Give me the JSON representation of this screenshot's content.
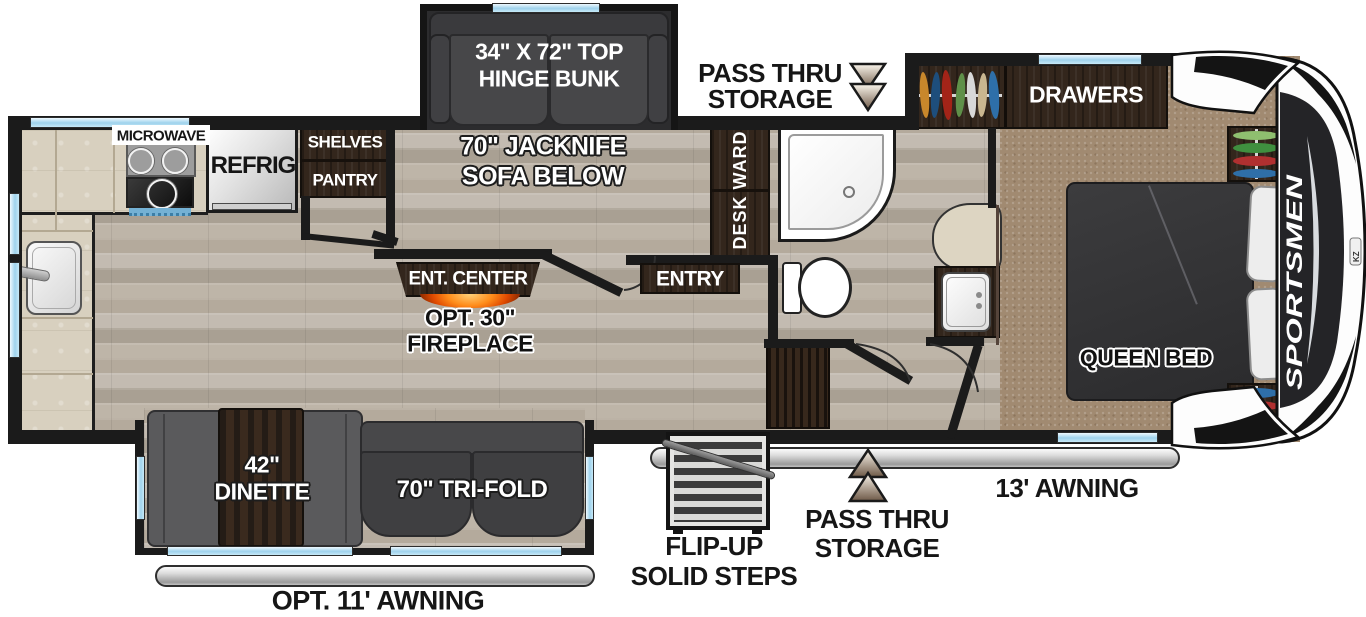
{
  "brand": {
    "name": "SPORTSMEN",
    "logo": "KZ"
  },
  "labels": {
    "microwave": "MICROWAVE",
    "refrig": "REFRIG",
    "shelves": "SHELVES",
    "pantry": "PANTRY",
    "bunk_line1": "34\" X 72\" TOP",
    "bunk_line2": "HINGE BUNK",
    "jacknife_line1": "70\" JACKNIFE",
    "jacknife_line2": "SOFA BELOW",
    "pass_thru_line1": "PASS THRU",
    "pass_thru_line2": "STORAGE",
    "desk_ward": "DESK WARD",
    "drawers": "DRAWERS",
    "entry": "ENTRY",
    "ent_center": "ENT. CENTER",
    "fireplace_line1": "OPT. 30\"",
    "fireplace_line2": "FIREPLACE",
    "queen_bed": "QUEEN BED",
    "dinette_line1": "42\"",
    "dinette_line2": "DINETTE",
    "tri_fold": "70\" TRI-FOLD",
    "steps_line1": "FLIP-UP",
    "steps_line2": "SOLID STEPS",
    "awning_13": "13' AWNING",
    "awning_11": "OPT. 11' AWNING"
  },
  "colors": {
    "wall": "#1b1b1b",
    "wood_floor": "#b6ada0",
    "carpet": "#a18a71",
    "cabinet_brown": "#33261c",
    "window_blue": "#9fd2ec",
    "sofa_gray": "#454547",
    "bed_gray": "#343436",
    "awning_gray": "#c9c9c9",
    "fireplace_orange": "#ff7a00",
    "arrow_tan": "#8a7260",
    "clothes": [
      "#c8872b",
      "#1e4e7c",
      "#a32418",
      "#5f9049",
      "#d8d8d8",
      "#c9b68f",
      "#2e6fa9"
    ]
  }
}
